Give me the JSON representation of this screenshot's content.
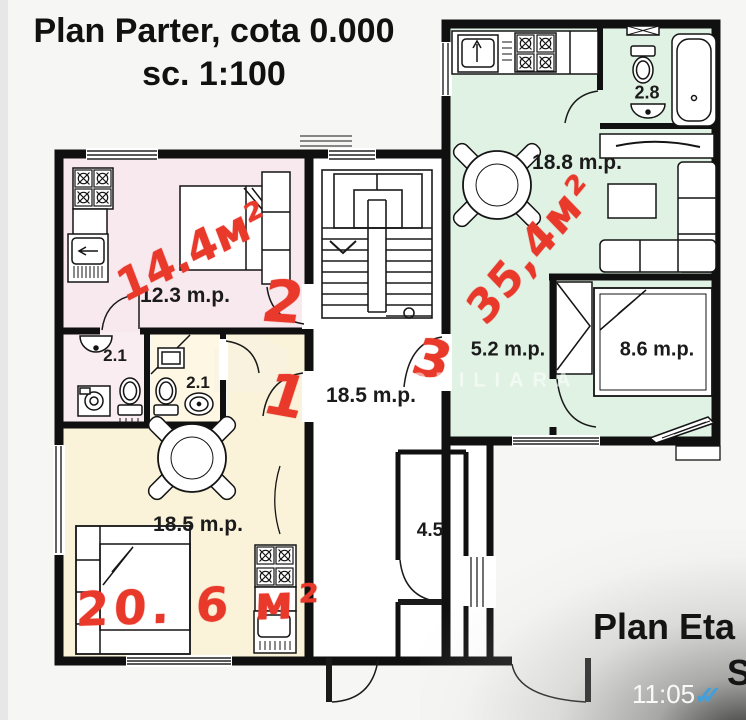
{
  "header": {
    "title_line1": "Plan Parter, cota 0.000",
    "title_line2": "sc. 1:100"
  },
  "plan": {
    "room_labels": {
      "apt2_room": "12.3 m.p.",
      "apt2_bath": "2.1",
      "apt1_bath": "2.1",
      "hallway": "18.5 m.p.",
      "apt1_room": "18.5 m.p.",
      "storage": "4.5",
      "apt3_bath": "2.8",
      "apt3_living": "18.8 m.p.",
      "apt3_corridor": "5.2 m.p.",
      "apt3_bedroom": "8.6 m.p."
    },
    "red_annotations": {
      "apt2_area": "14.4м²",
      "apt2_number": "2",
      "apt1_number": "1",
      "apt3_number": "3",
      "apt3_area": "35,4м²",
      "apt1_area": "20. 6 м²"
    },
    "watermark_text": "IMOBILIARĂ"
  },
  "footer": {
    "next_title": "Plan Eta",
    "next_subtitle": "S",
    "message_time": "11:05",
    "read_receipt": "✓✓"
  },
  "colors": {
    "apt2_fill": "#f8e9ee",
    "apt1_fill": "#faf3d9",
    "apt3_fill": "#e0f2e4",
    "wall_black": "#101010",
    "annotation_red": "#e8392b",
    "checkmark_blue": "#41a0dc"
  }
}
